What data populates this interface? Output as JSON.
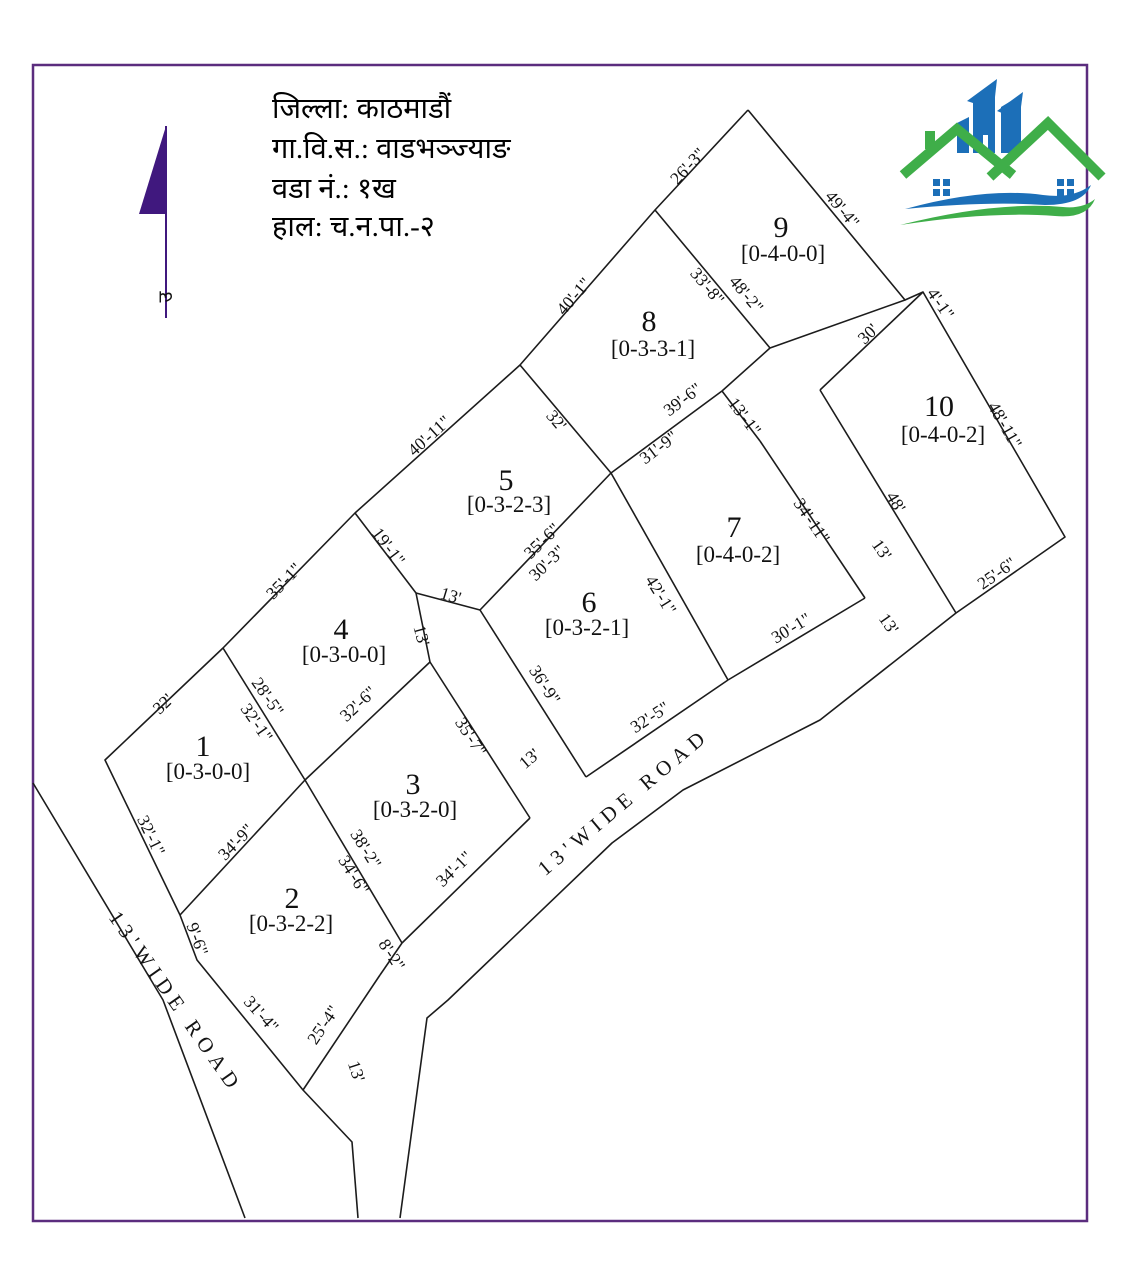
{
  "map": {
    "title_lines": [
      "जिल्ला: काठमाडौं",
      "गा.वि.स.: वाडभञ्ज्याङ",
      "वडा नं.: १ख",
      "हाल: च.न.पा.-२"
    ],
    "north_label": "उ",
    "colors": {
      "border": "#5b2d7e",
      "line": "#1c1c1c",
      "north_arrow": "#40187e",
      "logo_blue": "#1c6fb8",
      "logo_green": "#3fae49"
    },
    "roads": [
      {
        "label": "13'WIDE ROAD",
        "x": 628,
        "y": 807,
        "rot": -40
      },
      {
        "label": "13'WIDE ROAD",
        "x": 170,
        "y": 1006,
        "rot": 55
      }
    ],
    "plots": [
      {
        "number": "1",
        "area": "[0-3-0-0]",
        "nx": 203,
        "ny": 756,
        "ax": 208,
        "ay": 779
      },
      {
        "number": "2",
        "area": "[0-3-2-2]",
        "nx": 292,
        "ny": 908,
        "ax": 291,
        "ay": 931
      },
      {
        "number": "3",
        "area": "[0-3-2-0]",
        "nx": 413,
        "ny": 794,
        "ax": 415,
        "ay": 817
      },
      {
        "number": "4",
        "area": "[0-3-0-0]",
        "nx": 341,
        "ny": 639,
        "ax": 344,
        "ay": 662
      },
      {
        "number": "5",
        "area": "[0-3-2-3]",
        "nx": 506,
        "ny": 490,
        "ax": 509,
        "ay": 512
      },
      {
        "number": "6",
        "area": "[0-3-2-1]",
        "nx": 589,
        "ny": 612,
        "ax": 587,
        "ay": 635
      },
      {
        "number": "7",
        "area": "[0-4-0-2]",
        "nx": 734,
        "ny": 537,
        "ax": 738,
        "ay": 562
      },
      {
        "number": "8",
        "area": "[0-3-3-1]",
        "nx": 649,
        "ny": 331,
        "ax": 653,
        "ay": 356
      },
      {
        "number": "9",
        "area": "[0-4-0-0]",
        "nx": 781,
        "ny": 237,
        "ax": 783,
        "ay": 261
      },
      {
        "number": "10",
        "area": "[0-4-0-2]",
        "nx": 939,
        "ny": 416,
        "ax": 943,
        "ay": 442
      }
    ],
    "dimensions": [
      {
        "t": "26'-3\"",
        "x": 692,
        "y": 170,
        "r": -47
      },
      {
        "t": "49'-4\"",
        "x": 838,
        "y": 213,
        "r": 50
      },
      {
        "t": "33'-8\"",
        "x": 703,
        "y": 290,
        "r": 50
      },
      {
        "t": "48'-2\"",
        "x": 742,
        "y": 298,
        "r": 50
      },
      {
        "t": "40'-1\"",
        "x": 578,
        "y": 300,
        "r": -49
      },
      {
        "t": "4'-1\"",
        "x": 936,
        "y": 307,
        "r": 55
      },
      {
        "t": "30'",
        "x": 872,
        "y": 338,
        "r": -44
      },
      {
        "t": "48'-11\"",
        "x": 1000,
        "y": 428,
        "r": 60
      },
      {
        "t": "40'-11\"",
        "x": 433,
        "y": 440,
        "r": -42
      },
      {
        "t": "32'",
        "x": 552,
        "y": 424,
        "r": 50
      },
      {
        "t": "39'-6\"",
        "x": 686,
        "y": 404,
        "r": -37
      },
      {
        "t": "31'-9\"",
        "x": 662,
        "y": 452,
        "r": -37
      },
      {
        "t": "13'-1\"",
        "x": 740,
        "y": 420,
        "r": 53
      },
      {
        "t": "34'-11\"",
        "x": 807,
        "y": 524,
        "r": 56
      },
      {
        "t": "48'",
        "x": 891,
        "y": 505,
        "r": 59
      },
      {
        "t": "13'",
        "x": 877,
        "y": 553,
        "r": 55
      },
      {
        "t": "25'-6\"",
        "x": 1000,
        "y": 578,
        "r": -35
      },
      {
        "t": "13'",
        "x": 884,
        "y": 627,
        "r": 55
      },
      {
        "t": "19'-1\"",
        "x": 384,
        "y": 550,
        "r": 53
      },
      {
        "t": "35'-6\"",
        "x": 546,
        "y": 545,
        "r": -44
      },
      {
        "t": "30'-3\"",
        "x": 551,
        "y": 567,
        "r": -44
      },
      {
        "t": "35'-1\"",
        "x": 288,
        "y": 585,
        "r": -46
      },
      {
        "t": "13'",
        "x": 449,
        "y": 601,
        "r": 17
      },
      {
        "t": "13'",
        "x": 416,
        "y": 637,
        "r": 75
      },
      {
        "t": "42'-1\"",
        "x": 656,
        "y": 598,
        "r": 58
      },
      {
        "t": "36'-9\"",
        "x": 540,
        "y": 688,
        "r": 57
      },
      {
        "t": "30'-1\"",
        "x": 794,
        "y": 633,
        "r": -31
      },
      {
        "t": "32'-6\"",
        "x": 362,
        "y": 708,
        "r": -43
      },
      {
        "t": "28'-5\"",
        "x": 263,
        "y": 700,
        "r": 55
      },
      {
        "t": "32'-1\"",
        "x": 252,
        "y": 726,
        "r": 55
      },
      {
        "t": "32'",
        "x": 167,
        "y": 708,
        "r": -44
      },
      {
        "t": "35'-7\"",
        "x": 466,
        "y": 740,
        "r": 57
      },
      {
        "t": "13'",
        "x": 533,
        "y": 763,
        "r": -40
      },
      {
        "t": "32'-5\"",
        "x": 653,
        "y": 722,
        "r": -33
      },
      {
        "t": "34'-9\"",
        "x": 240,
        "y": 846,
        "r": -46
      },
      {
        "t": "38'-2\"",
        "x": 361,
        "y": 852,
        "r": 58
      },
      {
        "t": "34'-6\"",
        "x": 349,
        "y": 878,
        "r": 58
      },
      {
        "t": "34'-1\"",
        "x": 458,
        "y": 873,
        "r": -44
      },
      {
        "t": "32'-1\"",
        "x": 146,
        "y": 838,
        "r": 64
      },
      {
        "t": "9'-6\"",
        "x": 192,
        "y": 941,
        "r": 70
      },
      {
        "t": "8'-2\"",
        "x": 387,
        "y": 958,
        "r": 57
      },
      {
        "t": "31'-4\"",
        "x": 257,
        "y": 1018,
        "r": 48
      },
      {
        "t": "25'-4\"",
        "x": 328,
        "y": 1028,
        "r": -56
      },
      {
        "t": "13'",
        "x": 351,
        "y": 1073,
        "r": 72
      }
    ],
    "geometry": {
      "outer_east": [
        [
          748,
          110
        ],
        [
          905,
          300
        ],
        [
          923,
          292
        ],
        [
          1065,
          537
        ],
        [
          956,
          613
        ],
        [
          820,
          720
        ],
        [
          683,
          790
        ],
        [
          612,
          843
        ],
        [
          448,
          1000
        ],
        [
          427,
          1018
        ],
        [
          400,
          1218
        ]
      ],
      "outer_west": [
        [
          748,
          110
        ],
        [
          655,
          210
        ],
        [
          520,
          365
        ],
        [
          355,
          513
        ],
        [
          223,
          648
        ],
        [
          105,
          760
        ],
        [
          180,
          915
        ],
        [
          197,
          960
        ],
        [
          303,
          1090
        ],
        [
          352,
          1142
        ],
        [
          358,
          1218
        ]
      ],
      "west_road_edge": [
        [
          33,
          783
        ],
        [
          163,
          1000
        ],
        [
          245,
          1218
        ]
      ],
      "interior": [
        [
          [
            655,
            210
          ],
          [
            770,
            348
          ]
        ],
        [
          [
            770,
            348
          ],
          [
            905,
            300
          ]
        ],
        [
          [
            770,
            348
          ],
          [
            722,
            391
          ]
        ],
        [
          [
            722,
            391
          ],
          [
            611,
            473
          ]
        ],
        [
          [
            520,
            365
          ],
          [
            611,
            473
          ]
        ],
        [
          [
            722,
            391
          ],
          [
            760,
            441
          ]
        ],
        [
          [
            760,
            441
          ],
          [
            865,
            598
          ]
        ],
        [
          [
            611,
            473
          ],
          [
            728,
            680
          ]
        ],
        [
          [
            611,
            473
          ],
          [
            480,
            610
          ]
        ],
        [
          [
            480,
            610
          ],
          [
            416,
            593
          ]
        ],
        [
          [
            355,
            513
          ],
          [
            416,
            593
          ]
        ],
        [
          [
            416,
            593
          ],
          [
            430,
            662
          ]
        ],
        [
          [
            430,
            662
          ],
          [
            305,
            780
          ]
        ],
        [
          [
            305,
            780
          ],
          [
            223,
            648
          ]
        ],
        [
          [
            305,
            780
          ],
          [
            180,
            915
          ]
        ],
        [
          [
            305,
            780
          ],
          [
            402,
            943
          ]
        ],
        [
          [
            430,
            662
          ],
          [
            530,
            818
          ]
        ],
        [
          [
            530,
            818
          ],
          [
            402,
            943
          ]
        ],
        [
          [
            402,
            943
          ],
          [
            380,
            975
          ]
        ],
        [
          [
            380,
            975
          ],
          [
            303,
            1090
          ]
        ],
        [
          [
            480,
            610
          ],
          [
            586,
            777
          ]
        ],
        [
          [
            586,
            777
          ],
          [
            728,
            680
          ]
        ],
        [
          [
            728,
            680
          ],
          [
            865,
            598
          ]
        ],
        [
          [
            820,
            390
          ],
          [
            923,
            292
          ]
        ],
        [
          [
            820,
            390
          ],
          [
            956,
            613
          ]
        ]
      ]
    },
    "north_arrow": {
      "line": [
        [
          166,
          126
        ],
        [
          166,
          318
        ]
      ],
      "triangle": [
        [
          166,
          126
        ],
        [
          139,
          214
        ],
        [
          166,
          214
        ]
      ],
      "label_x": 167,
      "label_y": 302
    },
    "border": {
      "x": 33,
      "y": 65,
      "w": 1054,
      "h": 1156
    }
  }
}
